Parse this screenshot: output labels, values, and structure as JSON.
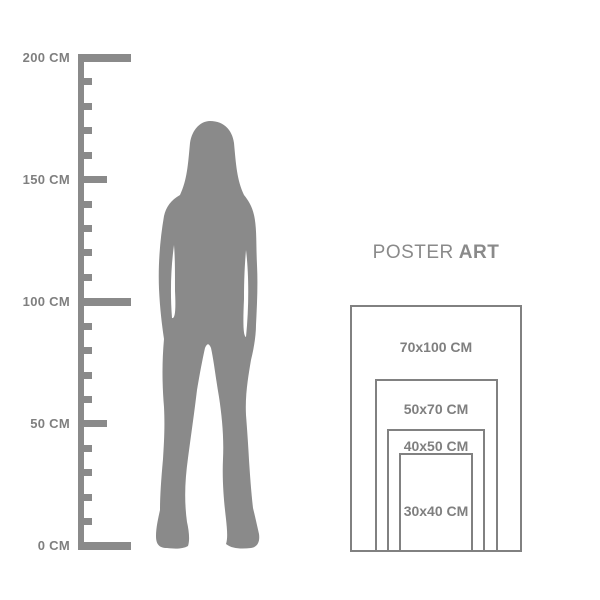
{
  "colors": {
    "background": "#ffffff",
    "graphic": "#8a8a8a",
    "outline": "#818181",
    "text": "#7f7f7f",
    "title": "#8a8a8a"
  },
  "ruler": {
    "unit": "CM",
    "min_cm": 0,
    "max_cm": 200,
    "minor_step_cm": 10,
    "medium_step_cm": 50,
    "major_step_cm": 100,
    "labels": [
      {
        "cm": 200,
        "text": "200 CM"
      },
      {
        "cm": 150,
        "text": "150 CM"
      },
      {
        "cm": 100,
        "text": "100 CM"
      },
      {
        "cm": 50,
        "text": "50 CM"
      },
      {
        "cm": 0,
        "text": "0 CM"
      }
    ]
  },
  "figure": {
    "icon": "woman-silhouette"
  },
  "poster_guide": {
    "title": {
      "regular": "POSTER",
      "bold": "ART"
    },
    "sizes": [
      {
        "label": "70x100 CM",
        "width_cm": 70,
        "height_cm": 100
      },
      {
        "label": "50x70 CM",
        "width_cm": 50,
        "height_cm": 70
      },
      {
        "label": "40x50 CM",
        "width_cm": 40,
        "height_cm": 50
      },
      {
        "label": "30x40 CM",
        "width_cm": 30,
        "height_cm": 40
      }
    ]
  }
}
